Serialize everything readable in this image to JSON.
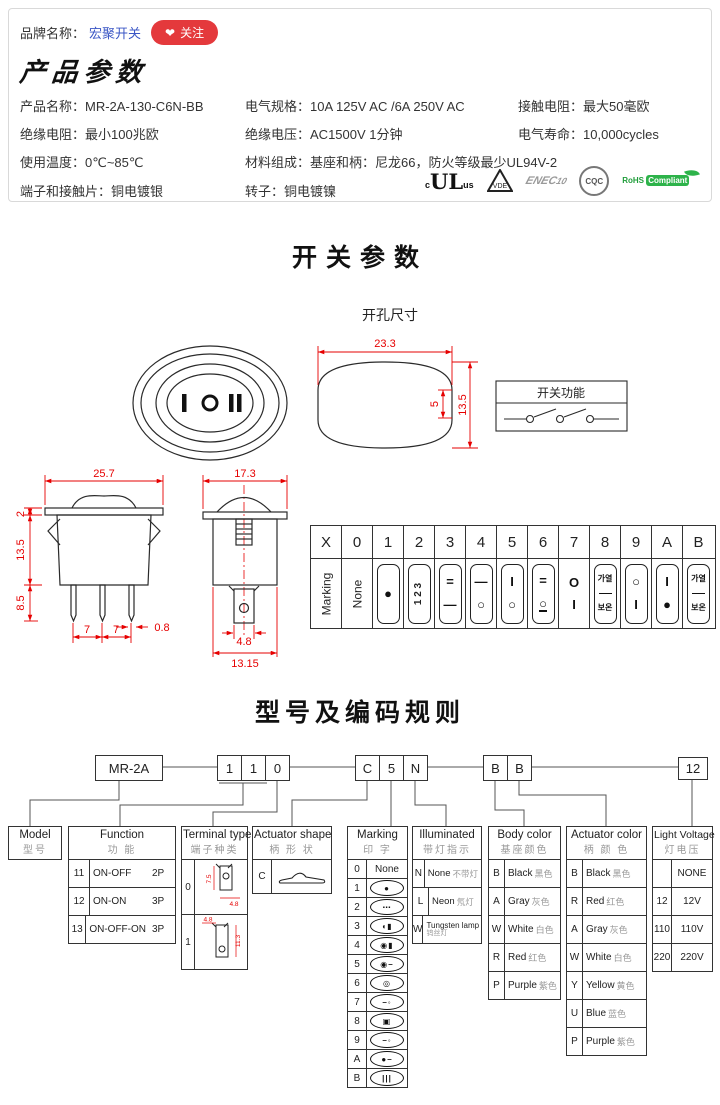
{
  "colors": {
    "accent_red": "#e4393c",
    "link_blue": "#3a56c5",
    "dim_red": "#e60000",
    "rohs_green": "#1f9d3a"
  },
  "header": {
    "brand_label": "品牌名称：",
    "brand_name": "宏聚开关",
    "heart": "❤",
    "follow_label": "关注"
  },
  "product": {
    "title": "产品参数",
    "fields": [
      {
        "label": "产品名称：",
        "value": "MR-2A-130-C6N-BB"
      },
      {
        "label": "电气规格：",
        "value": "10A  125V  AC /6A 250V  AC"
      },
      {
        "label": "接触电阻：",
        "value": "最大50毫欧"
      },
      {
        "label": "绝缘电阻：",
        "value": "最小100兆欧"
      },
      {
        "label": "绝缘电压：",
        "value": "AC1500V 1分钟"
      },
      {
        "label": "电气寿命：",
        "value": "10,000cycles"
      },
      {
        "label": "使用温度：",
        "value": "0℃~85℃"
      },
      {
        "label": "材料组成：",
        "value": "基座和柄：尼龙66，防火等级最少UL94V-2"
      },
      {
        "label": "端子和接触片：",
        "value": "铜电镀银"
      },
      {
        "label": "转子：",
        "value": "铜电镀镍"
      }
    ],
    "certs": {
      "ul_c": "c",
      "ul": "UL",
      "ul_us": "us",
      "vde": "VDE",
      "enec": "ENEC",
      "enec_num": "10",
      "cqc": "CQC",
      "rohs1": "RoHS",
      "rohs2": "Compliant"
    }
  },
  "sw": {
    "title": "开关参数",
    "hole_label": "开孔尺寸",
    "fn_title": "开关功能",
    "marks": {
      "l": "I",
      "m": "O",
      "r": "II"
    },
    "dims": {
      "hole_w": "23.3",
      "hole_h": "13.5",
      "notch": "5",
      "fw": "25.7",
      "flange": "2",
      "bh": "13.5",
      "pin": "8.5",
      "p1": "7",
      "p2": "7",
      "pw": "0.8",
      "sw": "17.3",
      "tab": "4.8",
      "sb": "13.15"
    },
    "mt": {
      "headers": [
        "X",
        "0",
        "1",
        "2",
        "3",
        "4",
        "5",
        "6",
        "7",
        "8",
        "9",
        "A",
        "B"
      ],
      "row_label": "Marking",
      "c0": "None",
      "c1": "●",
      "c2": "1 2 3",
      "c3t": "=",
      "c3b": "—",
      "c4t": "—",
      "c4b": "○",
      "c5t": "I",
      "c5b": "○",
      "c6t": "=",
      "c6b": "○",
      "c7t": "O",
      "c7b": "I",
      "c8a": "가열",
      "c8b": "보온",
      "c9t": "○",
      "c9b": "I",
      "cAt": "I",
      "cAb": "●",
      "cBt": "가열",
      "cBb": "보온"
    }
  },
  "coding": {
    "title": "型号及编码规则",
    "boxes": {
      "b0": "MR-2A",
      "d1": "1",
      "d2": "1",
      "d3": "0",
      "c1": "C",
      "c2": "5",
      "c3": "N",
      "e1": "B",
      "e2": "B",
      "v": "12"
    },
    "model": {
      "en": "Model",
      "cn": "型号"
    },
    "fn": {
      "en": "Function",
      "cn": "功 能",
      "rows": [
        [
          "11",
          "ON-OFF",
          "2P"
        ],
        [
          "12",
          "ON-ON",
          "3P"
        ],
        [
          "13",
          "ON-OFF-ON",
          "3P"
        ]
      ]
    },
    "term": {
      "en": "Terminal type",
      "cn": "端子种类",
      "codes": [
        "0",
        "1"
      ],
      "dims": {
        "a": "7.5",
        "b": "4.8",
        "c": "4.8",
        "d": "11.3"
      }
    },
    "shape": {
      "en": "Actuator shape",
      "cn": "柄 形 状",
      "code": "C"
    },
    "mark": {
      "en": "Marking",
      "cn": "印 字",
      "rows": [
        {
          "code": "0",
          "glyph": "None"
        },
        {
          "code": "1",
          "glyph": "●"
        },
        {
          "code": "2",
          "glyph": "⋯"
        },
        {
          "code": "3",
          "glyph": "◖▮"
        },
        {
          "code": "4",
          "glyph": "◉▮"
        },
        {
          "code": "5",
          "glyph": "◉–"
        },
        {
          "code": "6",
          "glyph": "◎"
        },
        {
          "code": "7",
          "glyph": "–◦"
        },
        {
          "code": "8",
          "glyph": "▣"
        },
        {
          "code": "9",
          "glyph": "–◦"
        },
        {
          "code": "A",
          "glyph": "●–"
        },
        {
          "code": "B",
          "glyph": "|||"
        }
      ]
    },
    "illum": {
      "en": "Illuminated",
      "cn": "带灯指示",
      "rows": [
        [
          "N",
          "None",
          "不带灯"
        ],
        [
          "L",
          "Neon",
          "氖灯"
        ],
        [
          "W",
          "Tungsten lamp",
          "钨丝灯"
        ]
      ]
    },
    "body": {
      "en": "Body color",
      "cn": "基座颜色",
      "rows": [
        [
          "B",
          "Black",
          "黑色"
        ],
        [
          "A",
          "Gray",
          "灰色"
        ],
        [
          "W",
          "White",
          "白色"
        ],
        [
          "R",
          "Red",
          "红色"
        ],
        [
          "P",
          "Purple",
          "紫色"
        ]
      ]
    },
    "act": {
      "en": "Actuator color",
      "cn": "柄 颜 色",
      "rows": [
        [
          "B",
          "Black",
          "黑色"
        ],
        [
          "R",
          "Red",
          "红色"
        ],
        [
          "A",
          "Gray",
          "灰色"
        ],
        [
          "W",
          "White",
          "白色"
        ],
        [
          "Y",
          "Yellow",
          "黄色"
        ],
        [
          "U",
          "Blue",
          "蓝色"
        ],
        [
          "P",
          "Purple",
          "紫色"
        ]
      ]
    },
    "lv": {
      "en": "Light Voltage",
      "cn": "灯电压",
      "rows": [
        [
          "",
          "NONE"
        ],
        [
          "12",
          "12V"
        ],
        [
          "110",
          "110V"
        ],
        [
          "220",
          "220V"
        ]
      ]
    }
  }
}
